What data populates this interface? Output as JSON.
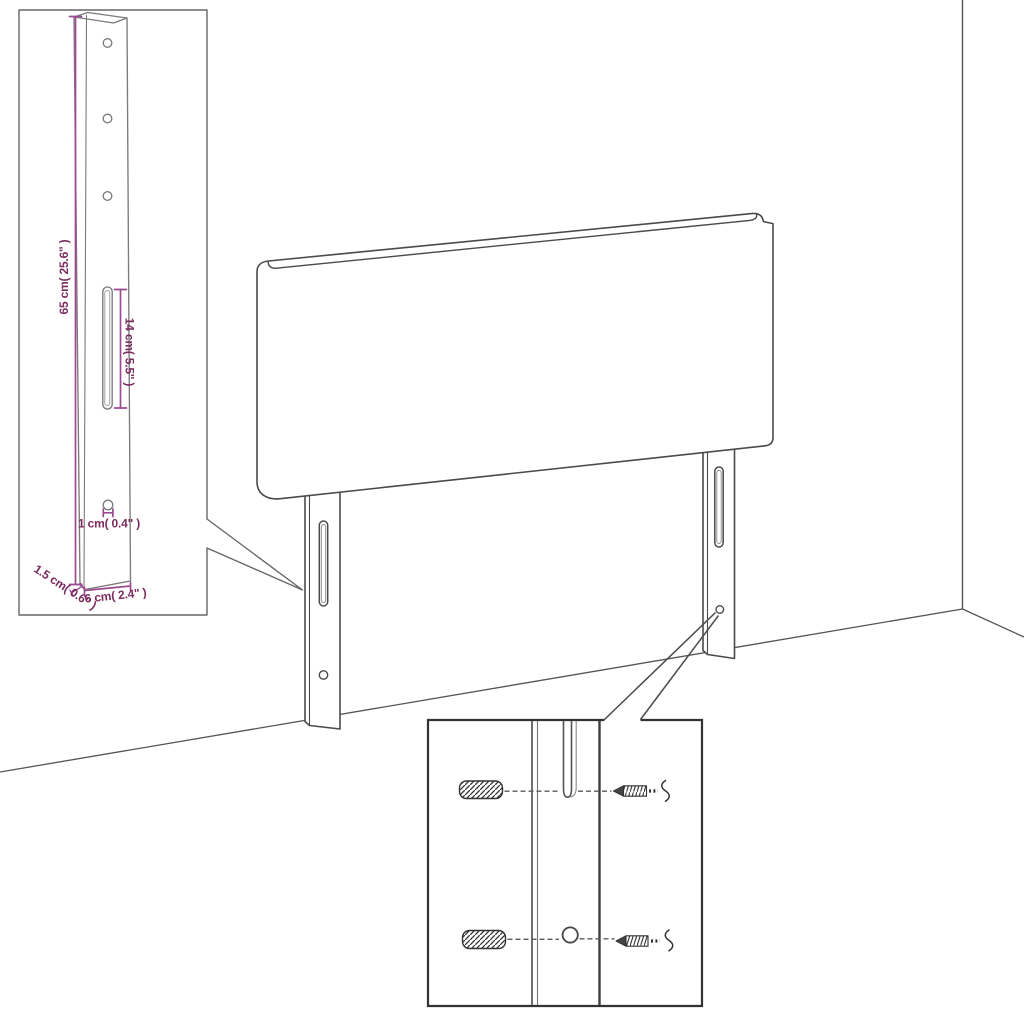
{
  "dimensions": {
    "height": "65 cm( 25.6\" )",
    "slot_length": "14 cm( 5.5\" )",
    "hole_diameter": "1 cm( 0.4\" )",
    "depth": "1.5 cm( 0.6\" )",
    "width": "6 cm( 2.4\" )"
  },
  "colors": {
    "outline": "#4a4a4a",
    "wall_line": "#555555",
    "bracket_line": "#7b7b7b",
    "inset_border": "#666666",
    "box_border": "#333333",
    "dimension_line": "#9b4a92",
    "dimension_text": "#7b2c5f",
    "hardware": "#333333",
    "background": "#ffffff"
  }
}
